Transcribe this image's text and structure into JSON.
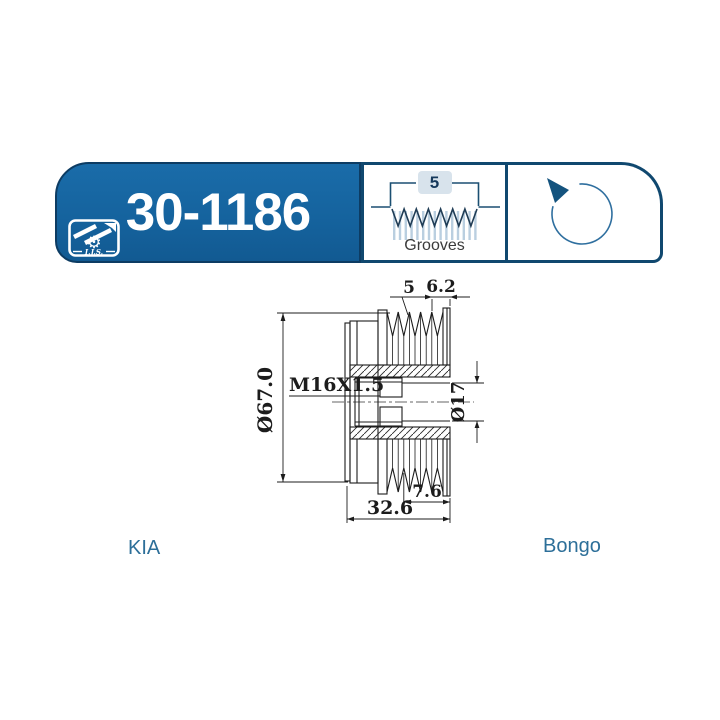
{
  "header": {
    "part_number": "30-1186",
    "logo": {
      "text": "I.J.S."
    },
    "grooves": {
      "count": "5",
      "label": "Grooves"
    },
    "rotation": {
      "direction": "counterclockwise"
    }
  },
  "drawing": {
    "dims": {
      "groove_count": "5",
      "groove_pitch": "6.2",
      "thread": "M16X1.5",
      "outer_diameter": "Ø67.0",
      "bore_diameter": "Ø17",
      "groove_section_width": "7.6",
      "overall_width": "32.6"
    }
  },
  "footer": {
    "make": "KIA",
    "model": "Bongo"
  },
  "colors": {
    "brand_blue": "#15639E",
    "border_navy": "#0D3C63",
    "cell_border": "#10486F",
    "accent_blue": "#2D6F99",
    "badge_bg": "#D8E3EC",
    "stripe_blue": "#BACFE0",
    "line_black": "#1C1C1C"
  }
}
